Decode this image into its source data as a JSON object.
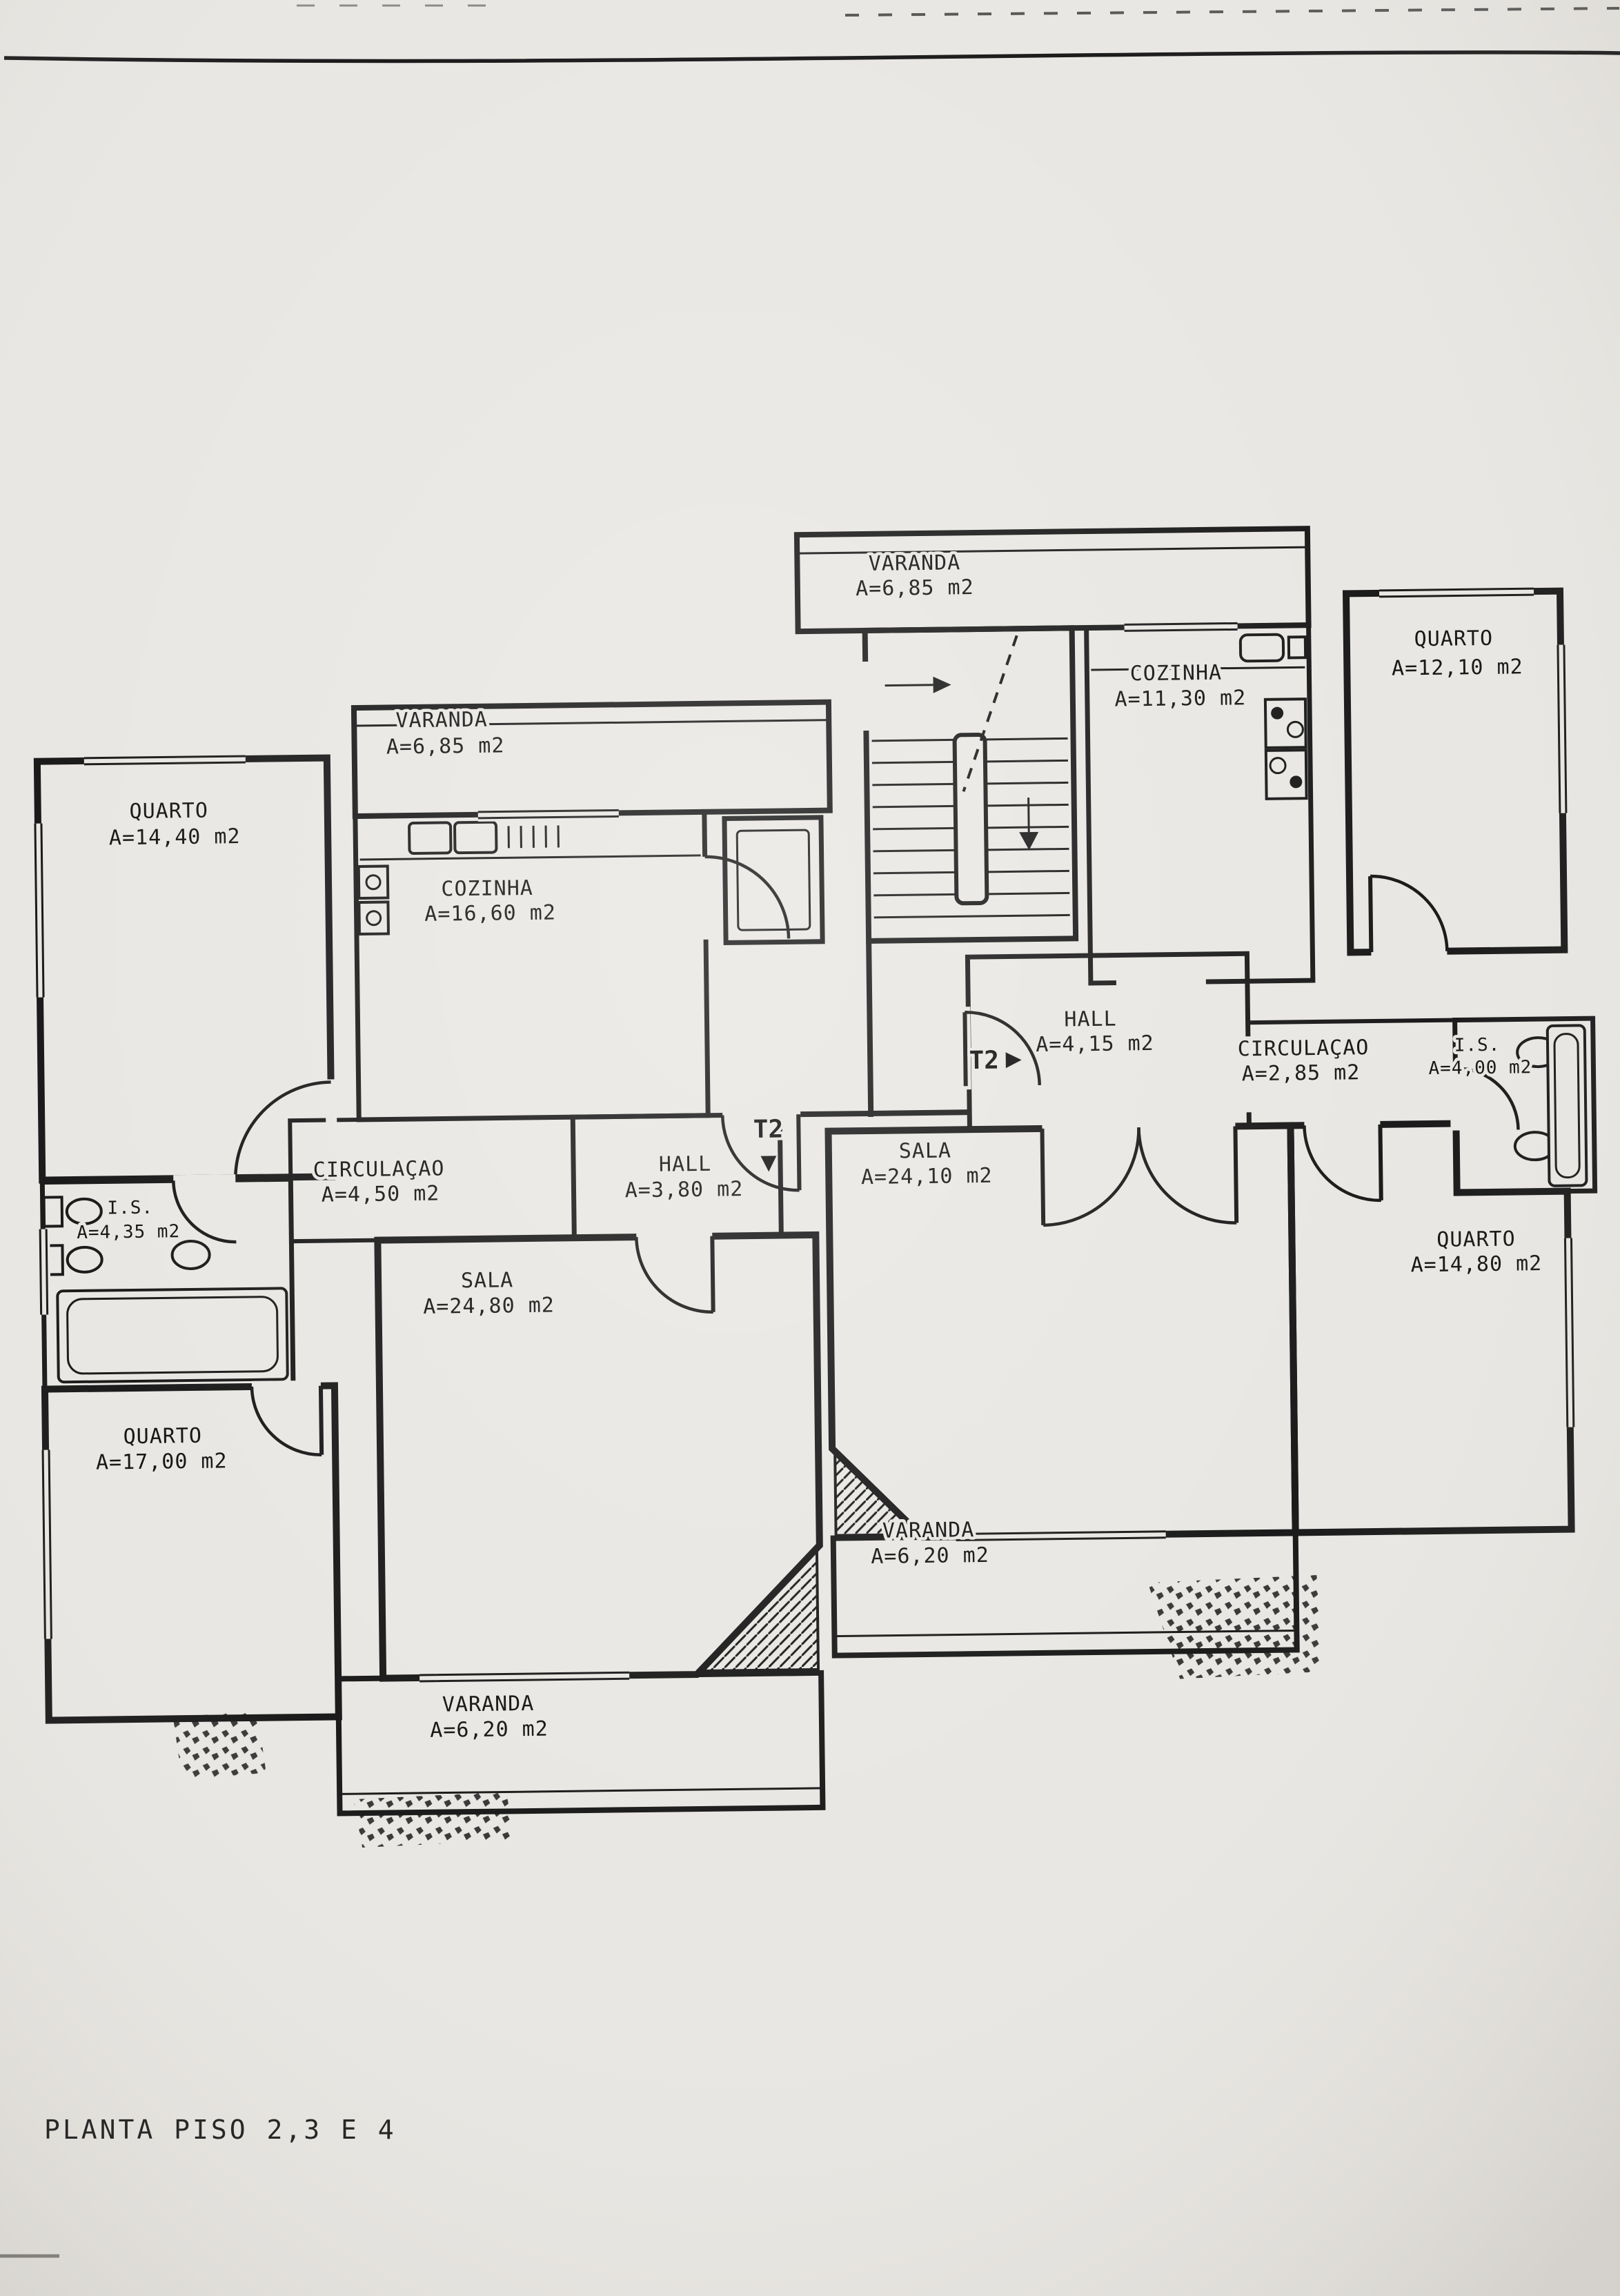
{
  "title": "PLANTA PISO 2,3 E 4",
  "unit_markers": [
    {
      "label": "T2",
      "arrow": "▶",
      "position": "right-unit-entry"
    },
    {
      "label": "T2",
      "arrow": "▼",
      "position": "left-unit-entry"
    }
  ],
  "rooms": [
    {
      "id": "varanda-top",
      "name": "VARANDA",
      "area": "A=6,85 m2"
    },
    {
      "id": "quarto-top-right",
      "name": "QUARTO",
      "area": "A=12,10 m2"
    },
    {
      "id": "cozinha-right",
      "name": "COZINHA",
      "area": "A=11,30 m2"
    },
    {
      "id": "varanda-left",
      "name": "VARANDA",
      "area": "A=6,85 m2"
    },
    {
      "id": "quarto-left-top",
      "name": "QUARTO",
      "area": "A=14,40 m2"
    },
    {
      "id": "cozinha-left",
      "name": "COZINHA",
      "area": "A=16,60 m2"
    },
    {
      "id": "hall-right",
      "name": "HALL",
      "area": "A=4,15 m2"
    },
    {
      "id": "circulacao-right",
      "name": "CIRCULAÇAO",
      "area": "A=2,85 m2"
    },
    {
      "id": "is-right",
      "name": "I.S.",
      "area": "A=4,00 m2"
    },
    {
      "id": "circulacao-left",
      "name": "CIRCULAÇAO",
      "area": "A=4,50 m2"
    },
    {
      "id": "hall-left",
      "name": "HALL",
      "area": "A=3,80 m2"
    },
    {
      "id": "sala-right",
      "name": "SALA",
      "area": "A=24,10 m2"
    },
    {
      "id": "sala-left",
      "name": "SALA",
      "area": "A=24,80 m2"
    },
    {
      "id": "is-left",
      "name": "I.S.",
      "area": "A=4,35 m2"
    },
    {
      "id": "quarto-left-bottom",
      "name": "QUARTO",
      "area": "A=17,00 m2"
    },
    {
      "id": "quarto-right-bottom",
      "name": "QUARTO",
      "area": "A=14,80 m2"
    },
    {
      "id": "varanda-right-bottom",
      "name": "VARANDA",
      "area": "A=6,20 m2"
    },
    {
      "id": "varanda-left-bottom",
      "name": "VARANDA",
      "area": "A=6,20 m2"
    }
  ],
  "colors": {
    "paper": "#e9e7e3",
    "ink": "#1b1b1b"
  }
}
